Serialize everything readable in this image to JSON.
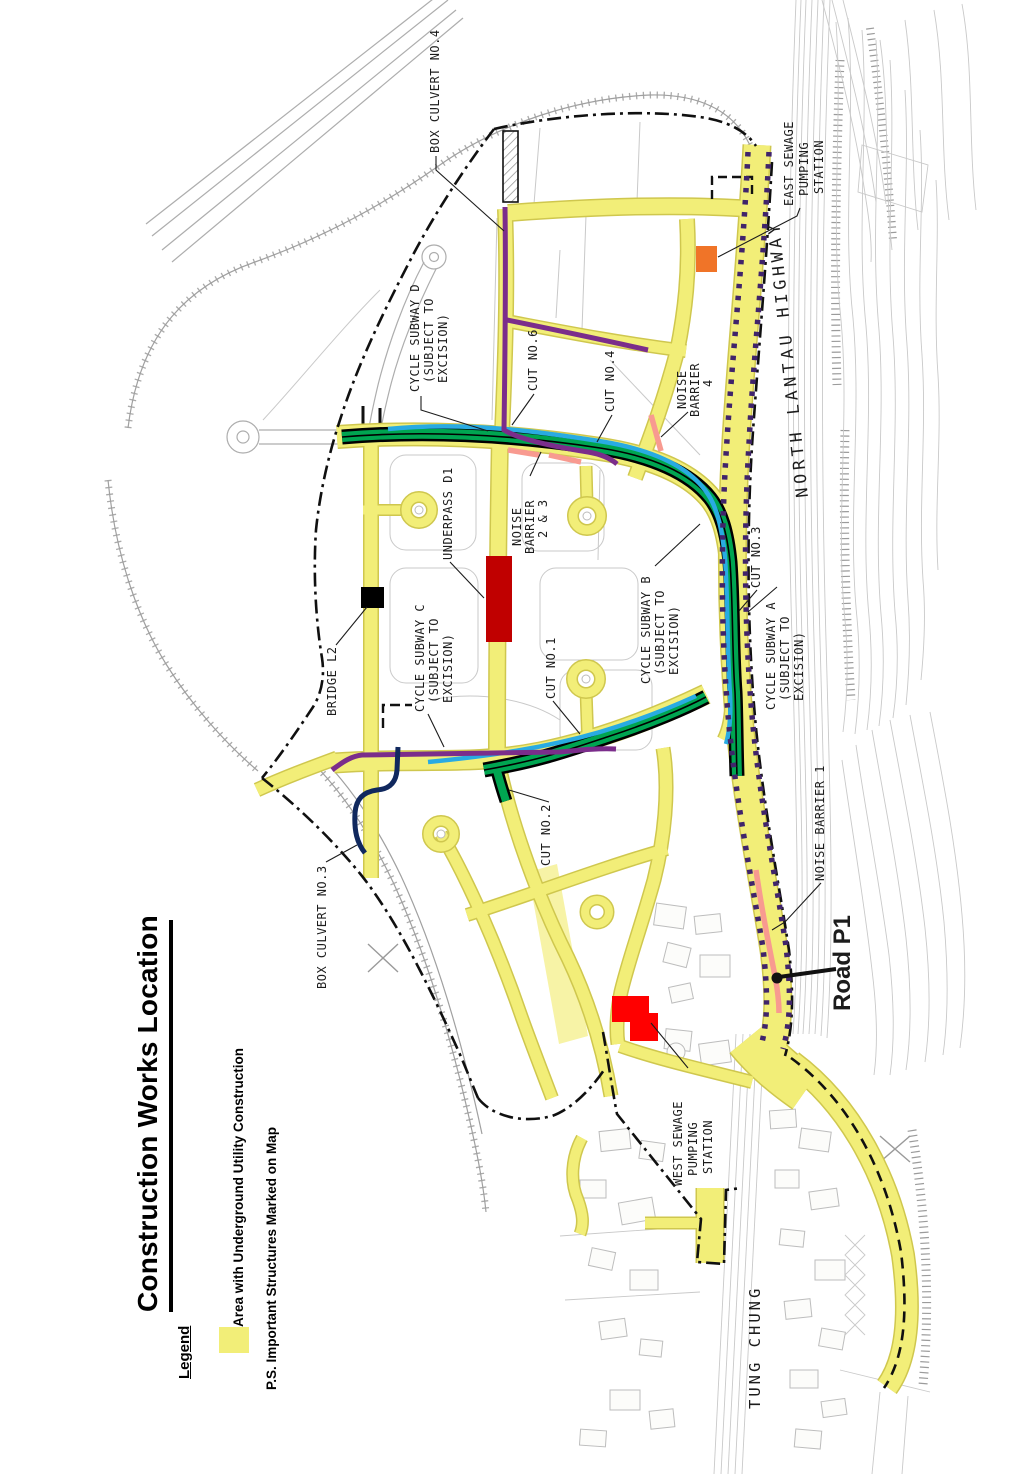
{
  "title": "Construction Works Location",
  "legend": {
    "heading": "Legend",
    "area_label": "Area with Underground Utility Construction",
    "note": "P.S. Important Structures Marked on Map"
  },
  "map_labels": {
    "box_culvert_4": "BOX CULVERT NO.4",
    "east_sewage_pumping_station": [
      "EAST SEWAGE",
      "PUMPING",
      "STATION"
    ],
    "north_lantau_highway": "NORTH LANTAU HIGHWAY",
    "cycle_subway_d": [
      "CYCLE SUBWAY D",
      "(SUBJECT TO",
      "EXCISION)"
    ],
    "cut_no6": "CUT NO.6",
    "cut_no4": "CUT NO.4",
    "noise_barrier_4": [
      "NOISE",
      "BARRIER",
      "4"
    ],
    "noise_barrier_2_3": [
      "NOISE",
      "BARRIER",
      "2 & 3"
    ],
    "underpass_d1": "UNDERPASS D1",
    "cycle_subway_b": [
      "CYCLE SUBWAY B",
      "(SUBJECT TO",
      "EXCISION)"
    ],
    "cut_no3": "CUT NO.3",
    "cycle_subway_a": [
      "CYCLE SUBWAY A",
      "(SUBJECT TO",
      "EXCISION)"
    ],
    "bridge_l2": "BRIDGE L2",
    "cycle_subway_c": [
      "CYCLE SUBWAY C",
      "(SUBJECT TO",
      "EXCISION)"
    ],
    "cut_no1": "CUT NO.1",
    "cut_no2": "CUT NO.2",
    "box_culvert_3": "BOX CULVERT NO.3",
    "noise_barrier_1": "NOISE BARRIER 1",
    "road_p1": "Road P1",
    "west_sewage_pumping_station": [
      "WEST SEWAGE",
      "PUMPING",
      "STATION"
    ],
    "tung_chung": "TUNG CHUNG"
  },
  "colors": {
    "yellow": "#F2EE78",
    "yellow-edge": "#CFC74E",
    "green": "#00A551",
    "cyan": "#29ABE2",
    "purple": "#7B2D8B",
    "navy": "#10285E",
    "pink": "#F89A90",
    "barrier": "#40246B",
    "underpass-red": "#C00000",
    "structure-red": "#FF0000",
    "structure-orange": "#F07428",
    "structure-black": "#000000"
  }
}
